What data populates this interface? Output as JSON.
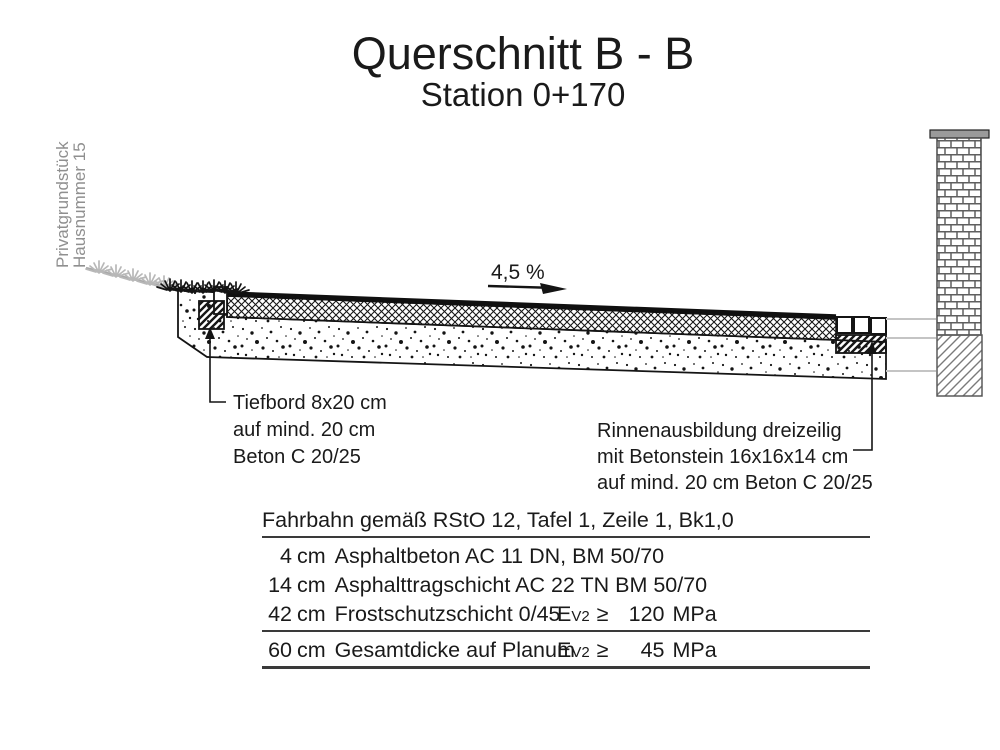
{
  "title": {
    "line1": "Querschnitt B - B",
    "line2": "Station 0+170"
  },
  "site": {
    "left_property": {
      "line1": "Privatgrundstück",
      "line2": "Hausnummer 15"
    }
  },
  "slope": {
    "label": "4,5 %"
  },
  "annotations": {
    "kerb": {
      "line1": "Tiefbord 8x20 cm",
      "line2": "auf mind. 20 cm",
      "line3": "Beton C 20/25"
    },
    "gutter": {
      "line1": "Rinnenausbildung dreizeilig",
      "line2": "mit Betonstein 16x16x14 cm",
      "line3": "auf mind. 20 cm Beton C 20/25"
    }
  },
  "table": {
    "header": "Fahrbahn gemäß RStO 12, Tafel 1, Zeile 1, Bk1,0",
    "rows": [
      {
        "depth": "4",
        "unit": "cm",
        "description": "Asphaltbeton AC 11 DN, BM 50/70",
        "spec_symbol": "",
        "spec_sub": "",
        "spec_op": "",
        "spec_value": "",
        "spec_unit": ""
      },
      {
        "depth": "14",
        "unit": "cm",
        "description": "Asphalttragschicht AC 22 TN BM 50/70",
        "spec_symbol": "",
        "spec_sub": "",
        "spec_op": "",
        "spec_value": "",
        "spec_unit": ""
      },
      {
        "depth": "42",
        "unit": "cm",
        "description": "Frostschutzschicht 0/45",
        "spec_symbol": "E",
        "spec_sub": "V2",
        "spec_op": "≥",
        "spec_value": "120",
        "spec_unit": "MPa"
      },
      {
        "depth": "60",
        "unit": "cm",
        "description": "Gesamtdicke auf Planum",
        "spec_symbol": "E",
        "spec_sub": "V2",
        "spec_op": "≥",
        "spec_value": "45",
        "spec_unit": "MPa"
      }
    ]
  },
  "colors": {
    "ink": "#1a1a1a",
    "muted_text": "#8f8f8f",
    "connector_gray": "#c4c4c4",
    "ground_gray": "#a8a8a8"
  }
}
